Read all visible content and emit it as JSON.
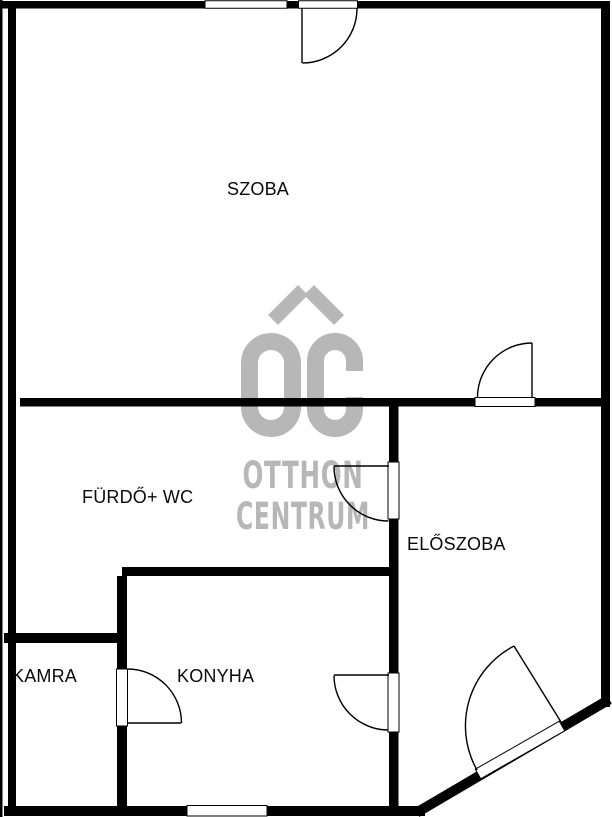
{
  "floorplan": {
    "background_color": "#ffffff",
    "wall_color": "#000000",
    "rooms": [
      {
        "label": "SZOBA"
      },
      {
        "label": "FÜRDŐ+ WC"
      },
      {
        "label": "ELŐSZOBA"
      },
      {
        "label": "KAMRA"
      },
      {
        "label": "KONYHA"
      }
    ],
    "watermark": {
      "line1": "OTTHON",
      "line2": "CENTRUM",
      "color": "#b7b7b7"
    }
  }
}
